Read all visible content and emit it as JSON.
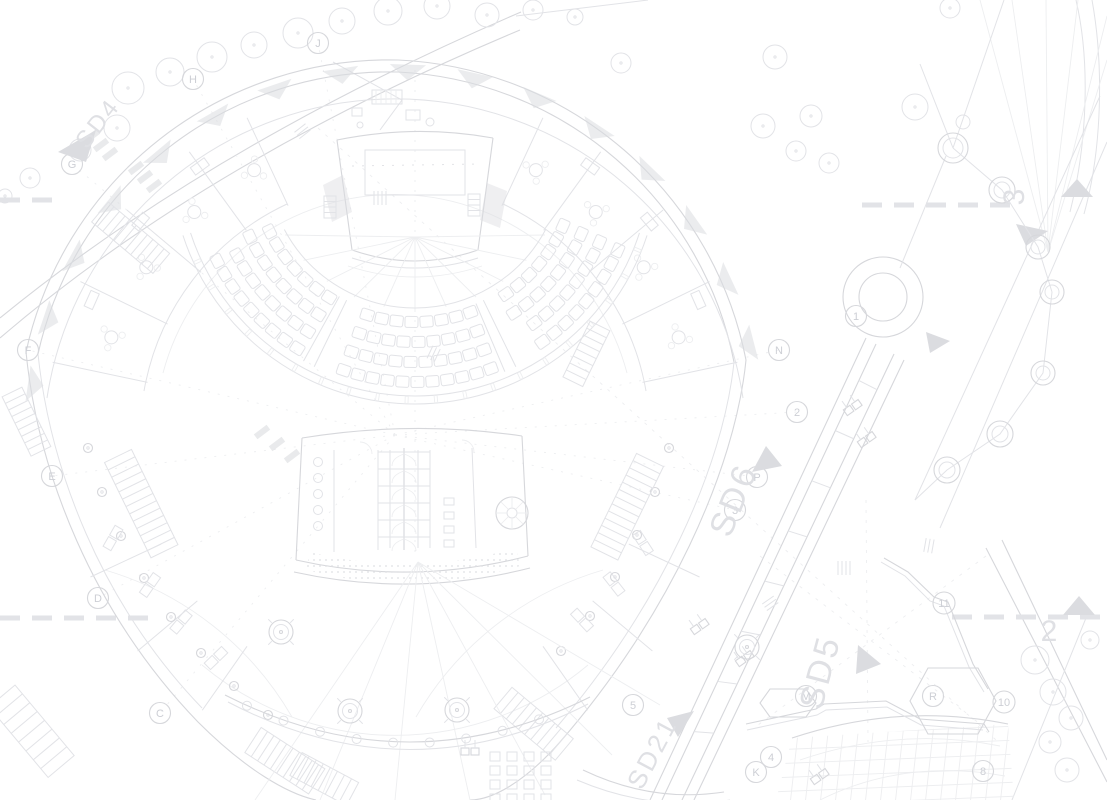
{
  "drawing": {
    "kind": "architectural-site-plan",
    "colors": {
      "background": "#ffffff",
      "line_main": "#d6d7db",
      "line_faint": "#e2e3e7",
      "line_faintest": "#edeef0",
      "marker_fill": "#dbdce0",
      "label_text": "#cdcfd5",
      "big_text": "#dfe0e4"
    }
  },
  "grid_bubbles": [
    {
      "label": "G",
      "x": 72,
      "y": 164
    },
    {
      "label": "H",
      "x": 193,
      "y": 79
    },
    {
      "label": "J",
      "x": 318,
      "y": 43
    },
    {
      "label": "F",
      "x": 28,
      "y": 350
    },
    {
      "label": "E",
      "x": 52,
      "y": 476
    },
    {
      "label": "D",
      "x": 98,
      "y": 598
    },
    {
      "label": "C",
      "x": 160,
      "y": 713
    },
    {
      "label": "N",
      "x": 779,
      "y": 350
    },
    {
      "label": "2",
      "x": 797,
      "y": 412
    },
    {
      "label": "P",
      "x": 757,
      "y": 477
    },
    {
      "label": "3",
      "x": 735,
      "y": 510
    },
    {
      "label": "1",
      "x": 856,
      "y": 316
    },
    {
      "label": "11",
      "x": 944,
      "y": 603
    },
    {
      "label": "M",
      "x": 806,
      "y": 696
    },
    {
      "label": "4",
      "x": 771,
      "y": 757
    },
    {
      "label": "K",
      "x": 756,
      "y": 772
    },
    {
      "label": "R",
      "x": 933,
      "y": 696
    },
    {
      "label": "10",
      "x": 1004,
      "y": 702
    },
    {
      "label": "8",
      "x": 983,
      "y": 771
    },
    {
      "label": "5",
      "x": 633,
      "y": 705
    }
  ],
  "section_markers": [
    {
      "label": "SD4",
      "x": 104,
      "y": 128,
      "rotation": -52,
      "font": 24,
      "triangle": "58,152 96,130 86,162"
    },
    {
      "label": "SD6",
      "x": 744,
      "y": 504,
      "rotation": -68,
      "font": 34,
      "triangle": "752,472 782,466 766,446"
    },
    {
      "label": "SD5",
      "x": 831,
      "y": 675,
      "rotation": -75,
      "font": 34,
      "triangle": "856,674 858,645 881,664"
    },
    {
      "label": "SD21",
      "x": 660,
      "y": 757,
      "rotation": -62,
      "font": 26,
      "triangle": "667,718 694,711 678,737"
    }
  ],
  "matchline_labels": [
    {
      "label": "3",
      "x": 1024,
      "y": 197,
      "rotation": -90,
      "font": 30
    },
    {
      "label": "2",
      "x": 1049,
      "y": 641,
      "rotation": 0,
      "font": 30
    }
  ]
}
